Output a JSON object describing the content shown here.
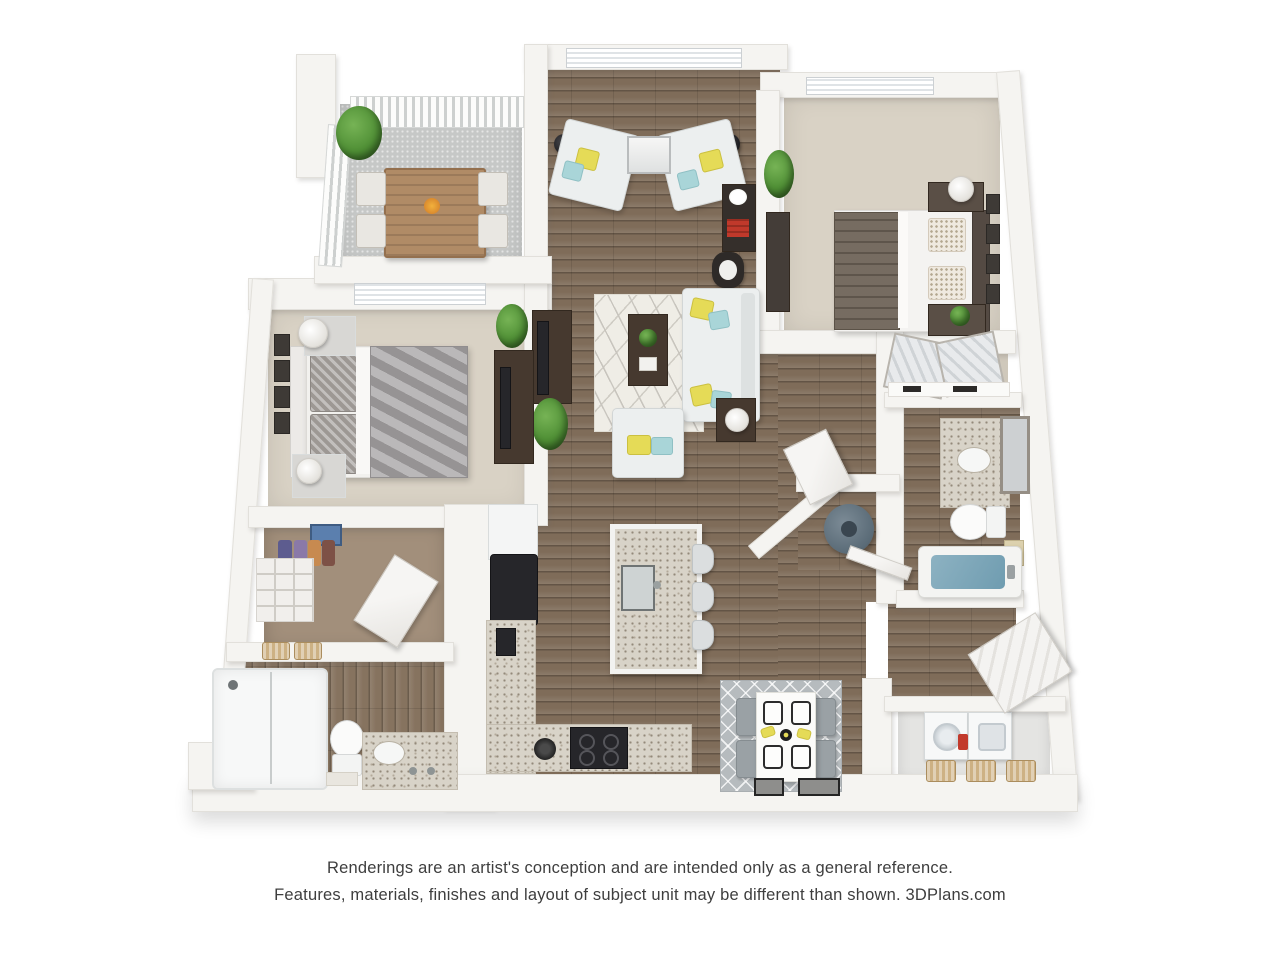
{
  "artwork": {
    "type": "3D apartment floor plan rendering",
    "view": "top-down perspective",
    "bedrooms": 2,
    "bathrooms": 2
  },
  "disclaimer": {
    "line1": "Renderings are an artist's conception and are intended only as a general reference.",
    "line2": "Features, materials, finishes and layout of subject unit may be different than shown. 3DPlans.com"
  },
  "branding": {
    "site": "3DPlans.com"
  },
  "rooms": [
    {
      "name": "Balcony"
    },
    {
      "name": "Living Room"
    },
    {
      "name": "Bedroom 2"
    },
    {
      "name": "Master Bedroom"
    },
    {
      "name": "Walk-in Closet"
    },
    {
      "name": "Master Bathroom"
    },
    {
      "name": "Kitchen"
    },
    {
      "name": "Dining Area"
    },
    {
      "name": "Hallway"
    },
    {
      "name": "Bathroom 2"
    },
    {
      "name": "Bedroom 2 Closet"
    },
    {
      "name": "Utility Closet"
    },
    {
      "name": "Laundry Room"
    },
    {
      "name": "Entry"
    }
  ],
  "palette": {
    "wall": "#f5f4f1",
    "wood_floor": "#7f6c59",
    "carpet": "#d9d2c5",
    "concrete": "#c6c8c7",
    "granite": "#d8d3c8",
    "accent_yellow": "#e5db57",
    "accent_teal": "#a9d5d8",
    "plant_green": "#4f8f35",
    "tub_water_blue": "#7fa8ba",
    "text": "#3e3e3e"
  }
}
